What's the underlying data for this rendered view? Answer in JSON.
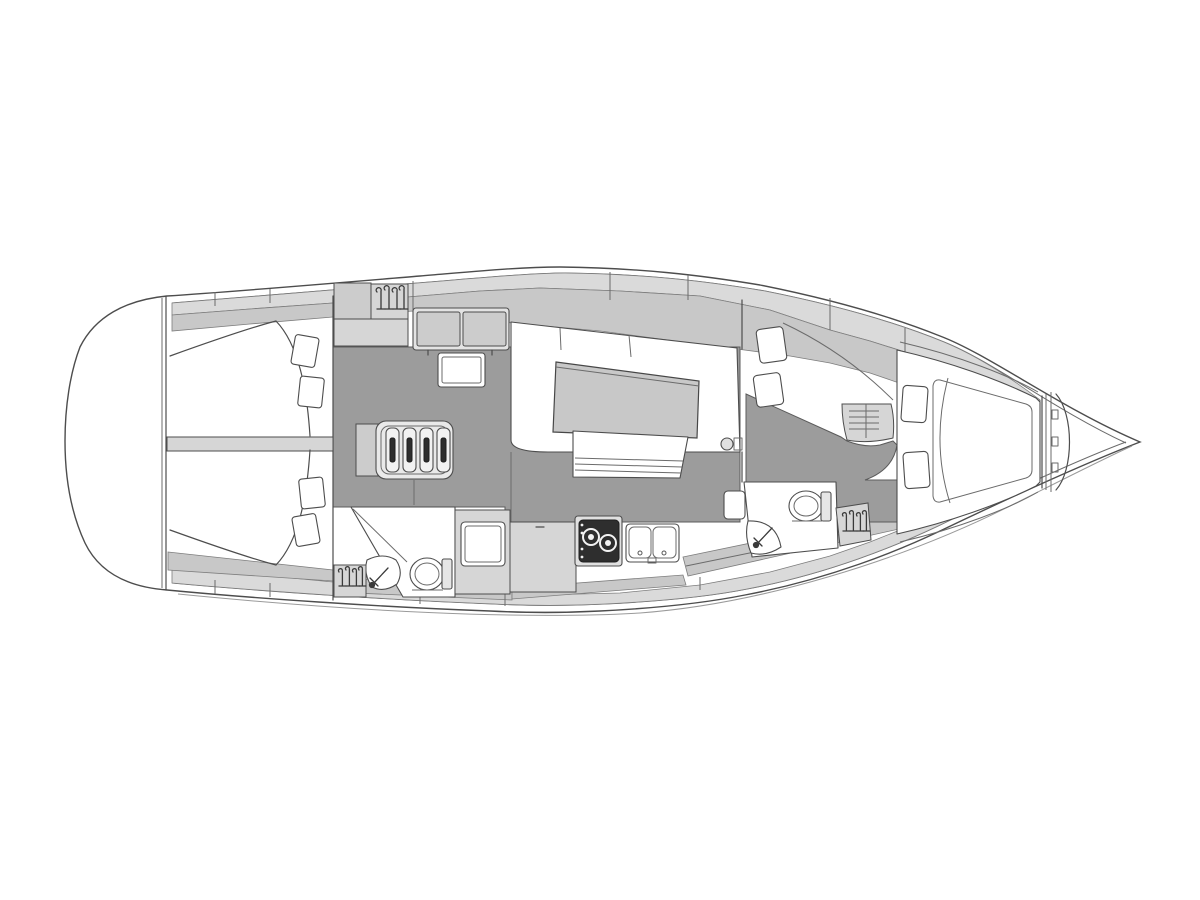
{
  "diagram": {
    "type": "yacht-interior-floor-plan",
    "orientation": "bow-pointing-right",
    "rooms": [
      {
        "id": "transom",
        "label": "rounded stern transom"
      },
      {
        "id": "aft-cabin-port",
        "label": "aft double cabin with berth and two pillows"
      },
      {
        "id": "aft-cabin-starboard",
        "label": "aft double cabin with berth and two pillows"
      },
      {
        "id": "saloon",
        "label": "saloon with U-shaped settee, table and bench"
      },
      {
        "id": "nav-station",
        "label": "chart table with two-cushion seat"
      },
      {
        "id": "galley",
        "label": "galley with counter, two-burner stove and double sink"
      },
      {
        "id": "aft-head",
        "label": "aft head with toilet, sink and shower locker"
      },
      {
        "id": "forward-head",
        "label": "forward head with toilet and sink"
      },
      {
        "id": "forward-cabin",
        "label": "owner cabin with sofa, drawers and island berth"
      },
      {
        "id": "anchor-locker",
        "label": "bow anchor locker"
      }
    ],
    "icons": [
      {
        "id": "companionway-steps-icon",
        "label": "companionway ladder, four treads"
      },
      {
        "id": "hanger-icon",
        "label": "wardrobe hanging locker (clothes hangers)",
        "count": 3
      },
      {
        "id": "stove-icon",
        "label": "two-burner stove"
      },
      {
        "id": "double-sink-icon",
        "label": "twin galley sinks"
      },
      {
        "id": "toilet-icon",
        "label": "marine toilet",
        "count": 2
      },
      {
        "id": "faucet-icon",
        "label": "basin tap",
        "count": 2
      },
      {
        "id": "pillow-icon",
        "label": "berth pillows",
        "count": 8
      },
      {
        "id": "mast-post-icon",
        "label": "mast compression post"
      }
    ]
  },
  "colors": {
    "bg": "#ffffff",
    "line": "#4d4d4d",
    "floor": "#9c9c9c",
    "band": "#dadada",
    "band2": "#c8c8c8",
    "furn": "#d6d6d6",
    "table": "#c8c8c8",
    "dark": "#2e2e2e"
  }
}
